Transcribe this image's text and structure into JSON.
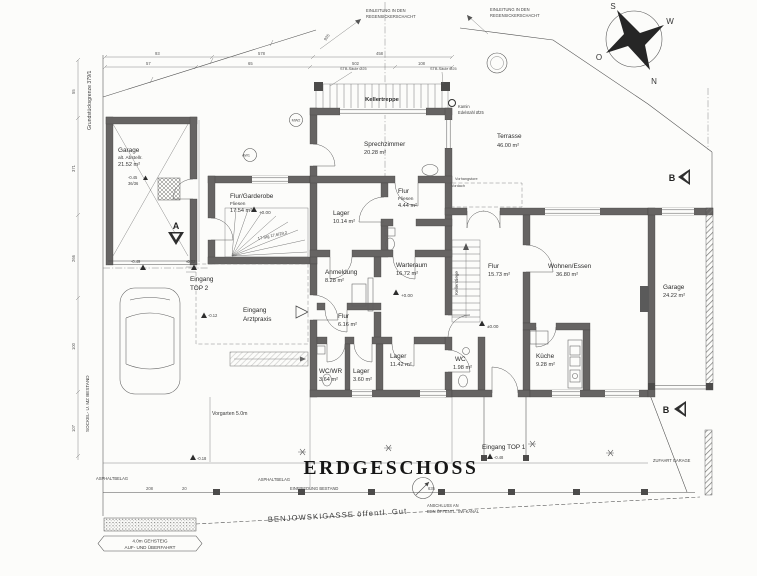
{
  "title": "ERDGESCHOSS",
  "compass": {
    "n": "N",
    "s": "S",
    "o": "O",
    "w": "W"
  },
  "rooms": {
    "garage_left": {
      "name": "Garage",
      "sub": "alt. Abstellr.",
      "area": "21.52 m²"
    },
    "flur_garderobe": {
      "name": "Flur/Garderobe",
      "sub": "Fliesen",
      "area": "17.54 m²"
    },
    "sprechzimmer": {
      "name": "Sprechzimmer",
      "area": "20.28 m²"
    },
    "terrasse": {
      "name": "Terrasse",
      "area": "46.00 m²"
    },
    "lager_1014": {
      "name": "Lager",
      "area": "10.14 m²"
    },
    "flur_444": {
      "name": "Flur",
      "sub": "Fliesen",
      "area": "4.44 m²"
    },
    "anmeldung": {
      "name": "Anmeldung",
      "area": "8.28 m²"
    },
    "warteraum": {
      "name": "Warteraum",
      "area": "16.72 m²"
    },
    "flur_1573": {
      "name": "Flur",
      "area": "15.73 m²"
    },
    "wohnen_essen": {
      "name": "Wohnen/Essen",
      "area": "36.80 m²"
    },
    "garage_right": {
      "name": "Garage",
      "area": "24.22 m²"
    },
    "flur_616": {
      "name": "Flur",
      "area": "6.16 m²"
    },
    "wc_wr": {
      "name": "WC/WR",
      "area": "3.64 m²"
    },
    "lager_360": {
      "name": "Lager",
      "area": "3.60 m²"
    },
    "lager_1142": {
      "name": "Lager",
      "area": "11.42 m²"
    },
    "wc_198": {
      "name": "WC",
      "area": "1.98 m²"
    },
    "kueche": {
      "name": "Küche",
      "area": "9.28 m²"
    }
  },
  "stairs": {
    "kellertreppe": "Kellertreppe",
    "kellerstiege": "Kellerstiege",
    "winder_note": "17 Stg 17,6/29,2"
  },
  "entrances": {
    "top2_l1": "Eingang",
    "top2_l2": "TOP 2",
    "arzt_l1": "Eingang",
    "arzt_l2": "Arztpraxis",
    "top1": "Eingang TOP 1"
  },
  "site": {
    "street": "BENJOWSKIGASSE öffentl. Gut",
    "vorgarten": "Vorgarten 5.0m",
    "asphalt": "ASPHALTBELAG",
    "einfriedung": "EINFRIEDUNG BESTAND",
    "anschluss_l1": "ANSCHLUSS AN",
    "anschluss_l2": "DEN ÖFFENTL. SW-KANAL",
    "zufahrt": "ZUFAHRT GARAGE",
    "gehsteig_l1": "4.0m GEHSTEIG",
    "gehsteig_l2": "AUF- UND ÜBERFAHRT",
    "grenze": "Grundstücksgrenze 379/1",
    "sockel": "SOCKEL- U. MZ BESTAND",
    "einleitung_l1": "EINLEITUNG IN DEN",
    "einleitung_l2": "REGENSICKERSCHACHT",
    "kamin_l1": "Kamin",
    "kamin_l2": "Edelstahl Ø25",
    "saule": "STB-Säule Ø25",
    "vordach": "Vordach",
    "vorhang": "Vorhangstore"
  },
  "levels": {
    "p000": "+0.00",
    "pm000": "±0.00",
    "m002": "-0.02",
    "m012": "-0.12",
    "m018": "-0.18",
    "m045": "-0.45",
    "m048": "-0.48",
    "m049": "-0.49",
    "grate": "36/36"
  },
  "sections": {
    "a": "A",
    "b": "B"
  },
  "markers": {
    "aw1": "AW1",
    "mw2": "MW2"
  },
  "dims": {
    "d57": "57",
    "d65": "65",
    "d578": "578",
    "d502": "502",
    "d93": "93",
    "d108": "108",
    "d458": "458",
    "d371": "371",
    "d266": "266",
    "d55": "55",
    "d100": "100",
    "d107": "107",
    "d208": "208",
    "d20": "20",
    "d635": "635",
    "d935": "935"
  }
}
